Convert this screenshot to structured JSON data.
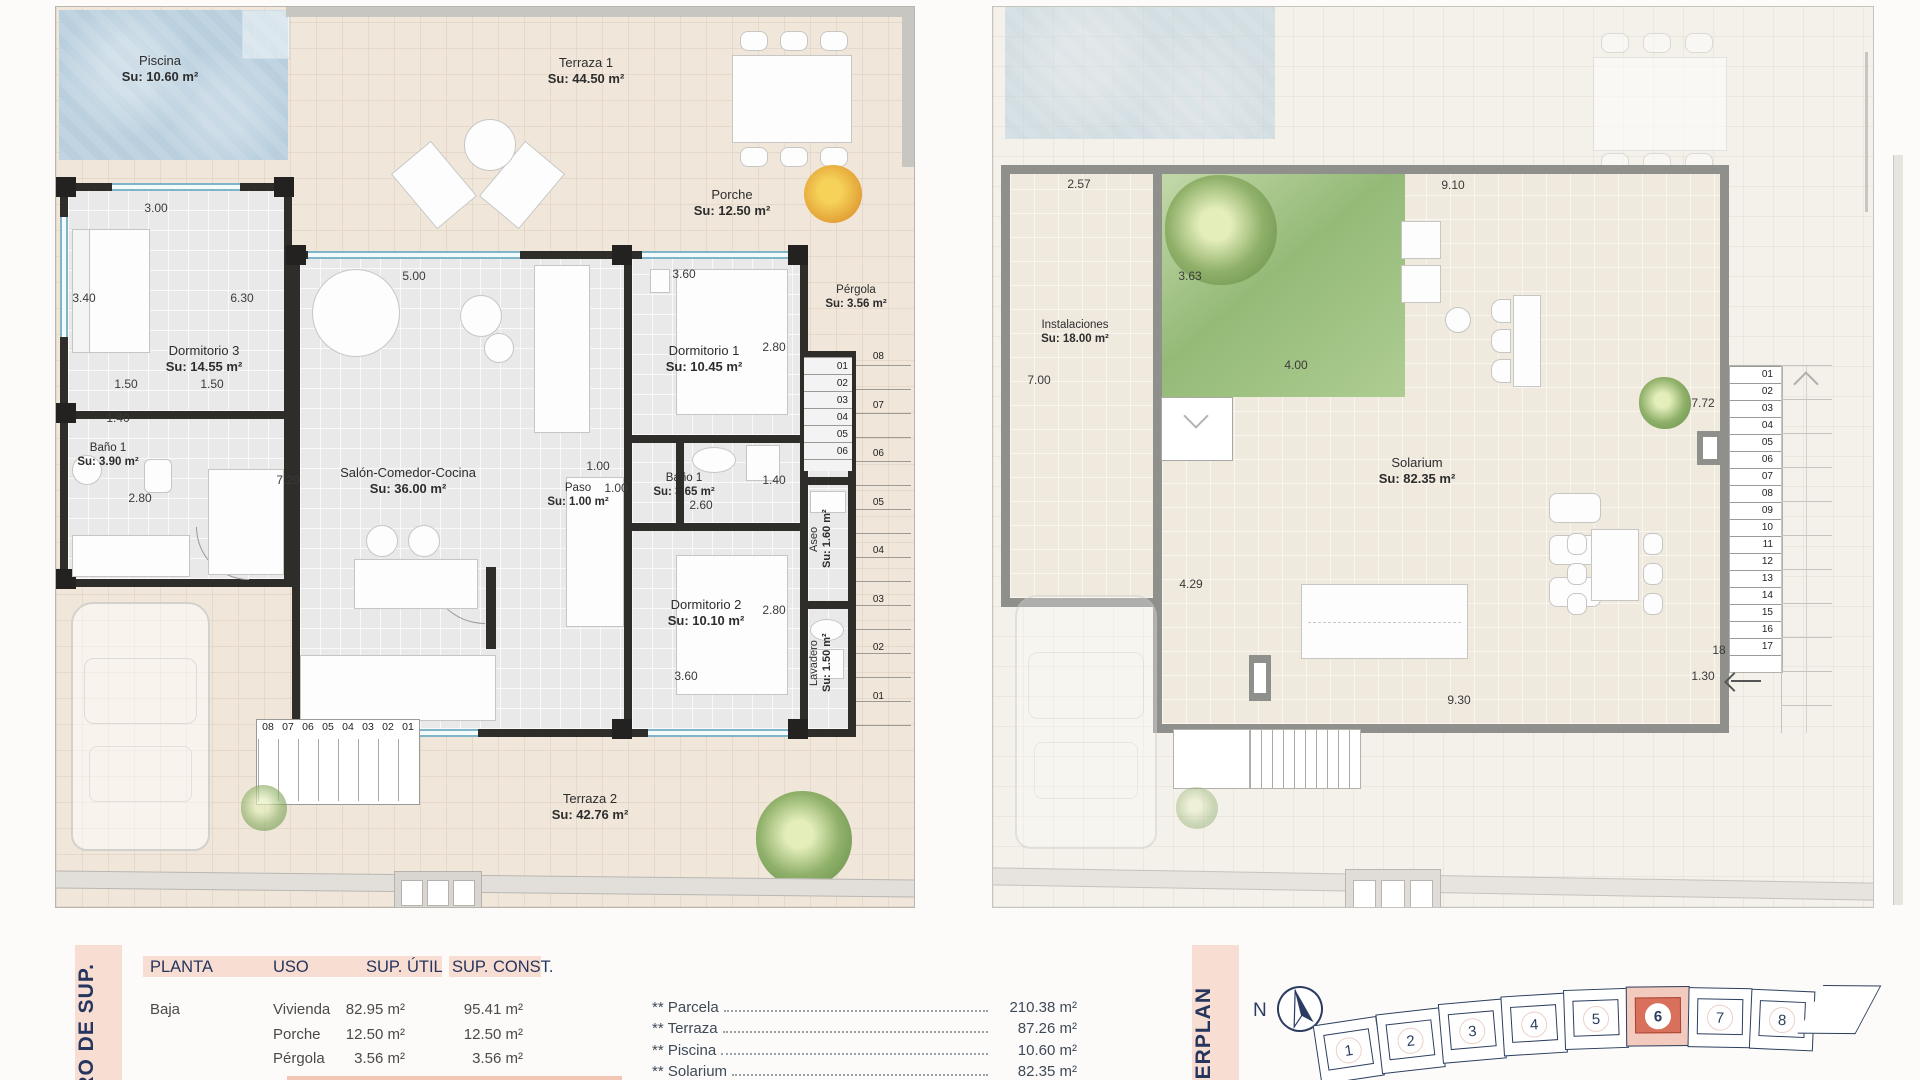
{
  "left_plan": {
    "rooms": {
      "piscina": {
        "name": "Piscina",
        "area": "Su: 10.60 m²"
      },
      "terraza1": {
        "name": "Terraza 1",
        "area": "Su: 44.50 m²"
      },
      "porche": {
        "name": "Porche",
        "area": "Su: 12.50 m²"
      },
      "dormitorio3": {
        "name": "Dormitorio 3",
        "area": "Su: 14.55 m²"
      },
      "bano1": {
        "name": "Baño 1",
        "area": "Su: 3.90 m²"
      },
      "salon": {
        "name": "Salón-Comedor-Cocina",
        "area": "Su: 36.00 m²"
      },
      "dormitorio1": {
        "name": "Dormitorio 1",
        "area": "Su: 10.45 m²"
      },
      "paso": {
        "name": "Paso",
        "area": "Su: 1.00 m²"
      },
      "bano2": {
        "name": "Baño 1",
        "area": "Su: 3.65 m²"
      },
      "dormitorio2": {
        "name": "Dormitorio 2",
        "area": "Su: 10.10 m²"
      },
      "aseo": {
        "name": "Aseo",
        "area": "Su: 1.60 m²"
      },
      "lavadero": {
        "name": "Lavadero",
        "area": "Su: 1.50 m²"
      },
      "pergola": {
        "name": "Pérgola",
        "area": "Su: 3.56 m²"
      },
      "terraza2": {
        "name": "Terraza 2",
        "area": "Su: 42.76 m²"
      }
    },
    "dims": {
      "d300": "3.00",
      "d340": "3.40",
      "d630": "6.30",
      "d150a": "1.50",
      "d150b": "1.50",
      "d140a": "1.40",
      "d280a": "2.80",
      "d720": "7.20",
      "d500": "5.00",
      "d360a": "3.60",
      "d280b": "2.80",
      "d100a": "1.00",
      "d100b": "1.00",
      "d260": "2.60",
      "d140b": "1.40",
      "d280c": "2.80",
      "d360b": "3.60"
    },
    "stairs": {
      "inner": [
        "01",
        "02",
        "03",
        "04",
        "05",
        "06"
      ],
      "outer": [
        "08",
        "07",
        "06",
        "05",
        "04",
        "03",
        "02",
        "01"
      ],
      "bottom": [
        "08",
        "07",
        "06",
        "05",
        "04",
        "03",
        "02",
        "01"
      ]
    }
  },
  "right_plan": {
    "rooms": {
      "instalaciones": {
        "name": "Instalaciones",
        "area": "Su: 18.00 m²"
      },
      "solarium": {
        "name": "Solarium",
        "area": "Su: 82.35 m²"
      }
    },
    "dims": {
      "d257": "2.57",
      "d910": "9.10",
      "d363": "3.63",
      "d400": "4.00",
      "d700": "7.00",
      "d429": "4.29",
      "d772": "7.72",
      "d930": "9.30",
      "d130": "1.30",
      "d18": "18"
    },
    "stairs": [
      "01",
      "02",
      "03",
      "04",
      "05",
      "06",
      "07",
      "08",
      "09",
      "10",
      "11",
      "12",
      "13",
      "14",
      "15",
      "16",
      "17"
    ]
  },
  "sidebar": {
    "left_label": "DRO DE SUP.",
    "right_label": "STERPLAN"
  },
  "table": {
    "headers": [
      "PLANTA",
      "USO",
      "SUP. ÚTIL",
      "SUP. CONST."
    ],
    "floor": "Baja",
    "rows": [
      {
        "uso": "Vivienda",
        "util": "82.95 m²",
        "const": "95.41 m²"
      },
      {
        "uso": "Porche",
        "util": "12.50 m²",
        "const": "12.50 m²"
      },
      {
        "uso": "Pérgola",
        "util": "3.56 m²",
        "const": "3.56 m²"
      }
    ]
  },
  "summary": {
    "items": [
      {
        "label": "** Parcela",
        "value": "210.38 m²"
      },
      {
        "label": "** Terraza",
        "value": "87.26 m²"
      },
      {
        "label": "** Piscina",
        "value": "10.60 m²"
      },
      {
        "label": "** Solarium",
        "value": "82.35 m²"
      }
    ]
  },
  "masterplan": {
    "north": "N",
    "plots": [
      {
        "num": "1"
      },
      {
        "num": "2"
      },
      {
        "num": "3"
      },
      {
        "num": "4"
      },
      {
        "num": "5"
      },
      {
        "num": "6",
        "highlighted": true
      },
      {
        "num": "7"
      },
      {
        "num": "8"
      }
    ]
  }
}
